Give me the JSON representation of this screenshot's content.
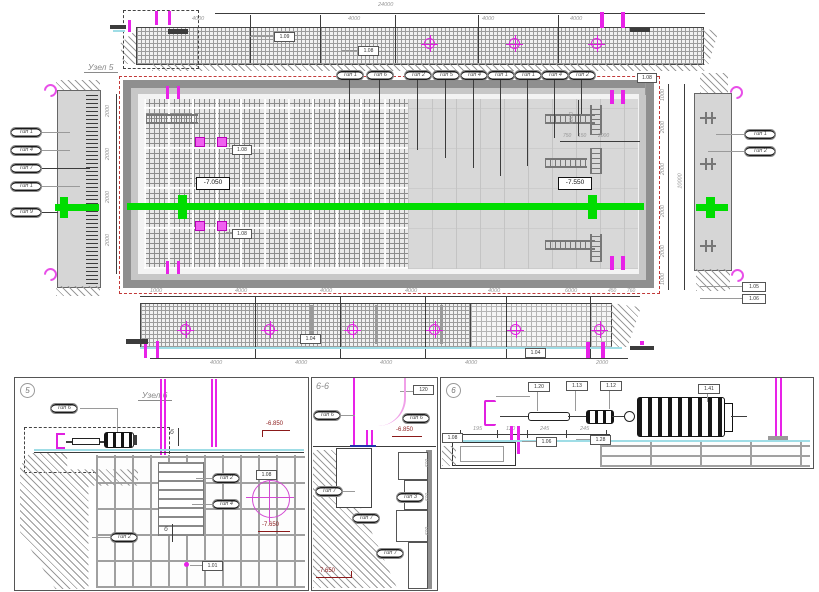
{
  "colors": {
    "accent_green": "#00dd00",
    "accent_magenta": "#e822e8",
    "dashed_red": "#c23a3a",
    "elevation_red": "#8b1a1a",
    "waterline_cyan": "#9fdde6"
  },
  "labels": {
    "uzel5": "Узел 5",
    "uzel6": "Узел 6",
    "panel5_num": "5",
    "panel6_num": "6",
    "panel66_title": "6-6",
    "section_mark": "6"
  },
  "dims": {
    "top_total": "24000",
    "top_segs": [
      "4000",
      "4000",
      "4000",
      "4000"
    ],
    "bottom_top_segs": [
      "1000",
      "4000",
      "4000",
      "4000",
      "4000",
      "6000"
    ],
    "below_right": [
      "450",
      "760"
    ],
    "bottom_bot_segs": [
      "4000",
      "4000",
      "4000",
      "4000",
      "2000"
    ],
    "right_segs": [
      "1000",
      "2000",
      "2000",
      "2000",
      "2000",
      "1000"
    ],
    "right_total": "10000",
    "left_segs": [
      "2000",
      "2000",
      "2000",
      "2000"
    ],
    "inner_vertical": "6000",
    "inner_row": [
      "750",
      "150",
      "2000"
    ],
    "panel6_segs": [
      "195",
      "120",
      "245",
      "245"
    ],
    "panel66_steps": [
      "600",
      "600",
      "600"
    ],
    "panel66_box": "120"
  },
  "elevations": {
    "plan_left": "-7.050",
    "plan_right": "-7.550",
    "p5_top": "-6.850",
    "p5_bottom": "-7.650",
    "p66_top": "-6.850",
    "p66_bottom": "-7.650"
  },
  "callouts": {
    "plan_top": [
      "Тип 1",
      "Тип 6",
      "Тип 2",
      "Тип 5",
      "Тип 4",
      "Тип 1",
      "Тип 1",
      "Тип 4",
      "Тип 2"
    ],
    "plan_left": [
      "Тип 1",
      "Тип 4",
      "Тип 7",
      "Тип 1",
      "Тип 9"
    ],
    "plan_right": [
      "Тип 1",
      "Тип 2"
    ],
    "p5": [
      "Тип 6",
      "Тип 2",
      "Тип 4",
      "Тип 2"
    ],
    "p66": [
      "Тип 6",
      "Тип 6",
      "Тип 7",
      "Тип 3",
      "Тип 7",
      "Тип 7"
    ]
  },
  "pos": {
    "top_strip": [
      "1.09",
      "1.08"
    ],
    "plan_mesh": [
      "1.08",
      "1.08"
    ],
    "plan_top_right": "1.08",
    "plan_corner": [
      "1.05",
      "1.06"
    ],
    "bottom_strip": [
      "1.04",
      "1.04"
    ],
    "p5": [
      "1.08",
      "1.01"
    ],
    "p6_top": [
      "1.20",
      "1.13",
      "1.12",
      "1.41"
    ],
    "p6_bottom": [
      "1.08",
      "1.06",
      "1.28"
    ]
  }
}
